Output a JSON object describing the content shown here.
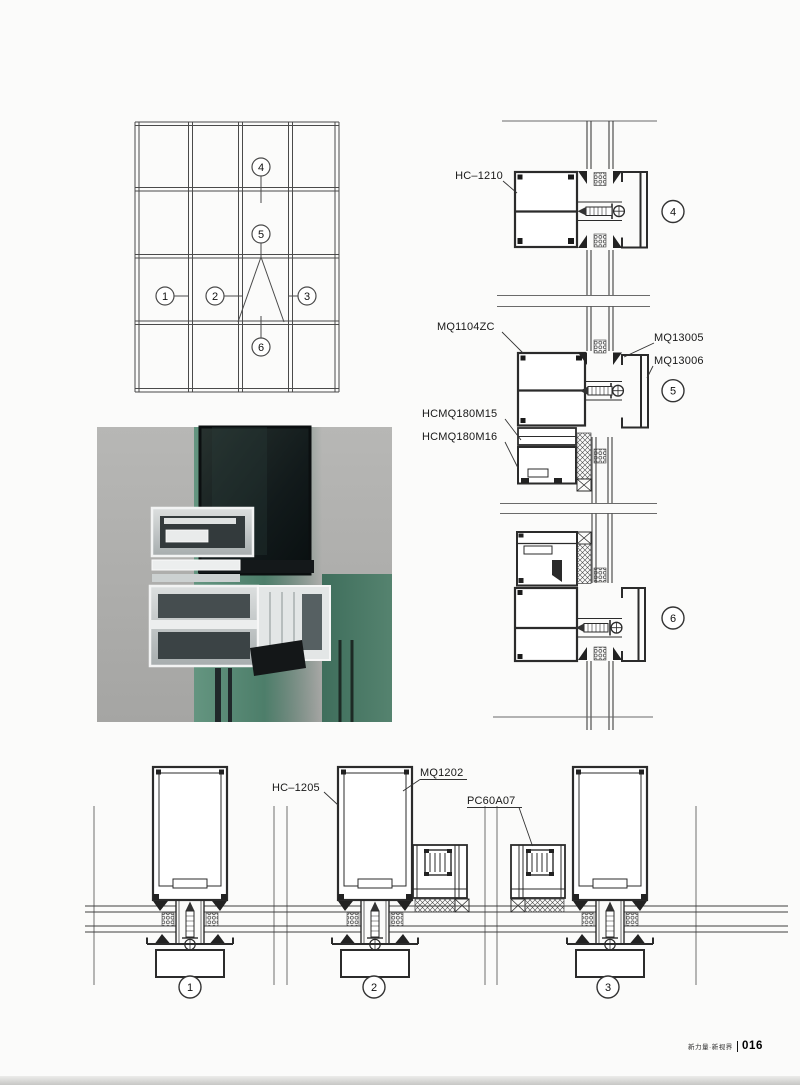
{
  "footer": {
    "brand": "新力量·新视界",
    "page": "016"
  },
  "elevation": {
    "callouts": {
      "1": "1",
      "2": "2",
      "3": "3",
      "4": "4",
      "5": "5",
      "6": "6"
    }
  },
  "labels": {
    "hc1210": "HC–1210",
    "mq1104zc": "MQ1104ZC",
    "mq13005": "MQ13005",
    "mq13006": "MQ13006",
    "hcmq180m15": "HCMQ180M15",
    "hcmq180m16": "HCMQ180M16",
    "hc1205": "HC–1205",
    "mq1202": "MQ1202",
    "pc60a07": "PC60A07"
  },
  "section_callouts": {
    "s1": "1",
    "s2": "2",
    "s3": "3",
    "s4": "4",
    "s5": "5",
    "s6": "6"
  }
}
